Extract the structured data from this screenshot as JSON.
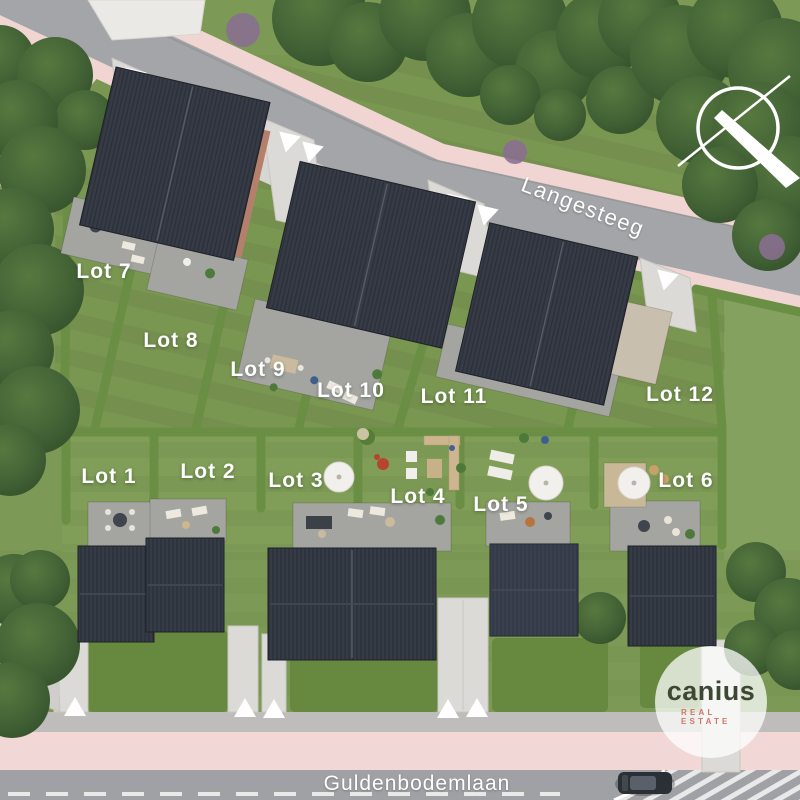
{
  "site": {
    "streets": {
      "top": "Langesteeg",
      "bottom": "Guldenbodemlaan"
    },
    "lots": [
      {
        "id": 1,
        "label": "Lot 1"
      },
      {
        "id": 2,
        "label": "Lot 2"
      },
      {
        "id": 3,
        "label": "Lot 3"
      },
      {
        "id": 4,
        "label": "Lot 4"
      },
      {
        "id": 5,
        "label": "Lot 5"
      },
      {
        "id": 6,
        "label": "Lot 6"
      },
      {
        "id": 7,
        "label": "Lot 7"
      },
      {
        "id": 8,
        "label": "Lot 8"
      },
      {
        "id": 9,
        "label": "Lot 9"
      },
      {
        "id": 10,
        "label": "Lot 10"
      },
      {
        "id": 11,
        "label": "Lot 11"
      },
      {
        "id": 12,
        "label": "Lot 12"
      }
    ],
    "logo": {
      "brand": "canius",
      "tagline": "REAL ESTATE"
    },
    "icons": {
      "compass": "compass-north-icon",
      "entrance_marker": "triangle-arrow-icon"
    },
    "colors": {
      "grass": "#7c9a55",
      "hedge": "#6a8f44",
      "tree": "#3f5c33",
      "road_asphalt": "#a0a1a4",
      "sidewalk_pink": "#f0d6d4",
      "paving_light": "#dcdad6",
      "roof_dark": "#363b45",
      "roof_tan": "#c9bfae",
      "label_text": "#ffffff",
      "logo_brand": "#3c4834",
      "logo_tagline": "#d0766a"
    }
  }
}
